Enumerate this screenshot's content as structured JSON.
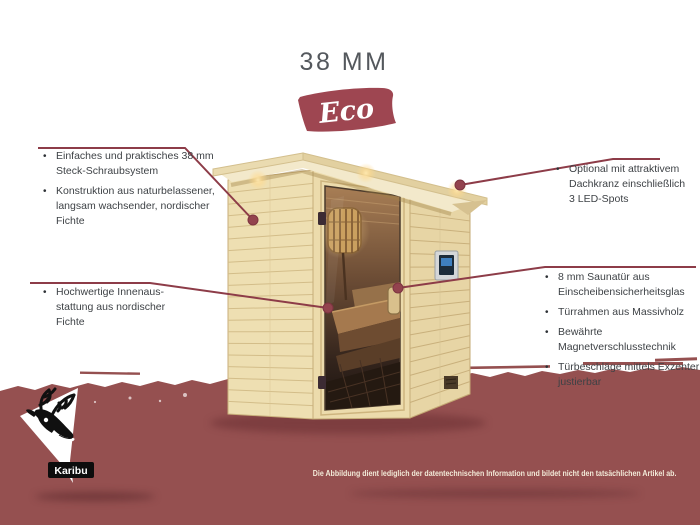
{
  "header": {
    "thickness_label": "38 MM",
    "badge_label": "Eco"
  },
  "ui": {
    "bullet_glyph": "•"
  },
  "callouts": {
    "left": [
      {
        "items": [
          {
            "text": "Einfaches und praktisches 38 mm\nSteck-Schraubsystem"
          },
          {
            "text": "Konstruktion aus naturbelassener,\nlangsam wachsender, nordischer\nFichte"
          }
        ]
      },
      {
        "items": [
          {
            "text": "Hochwertige Innenaus-\nstattung aus nordischer\nFichte"
          }
        ]
      }
    ],
    "right": [
      {
        "items": [
          {
            "text": "Optional mit attraktivem\nDachkranz einschließlich\n3 LED-Spots"
          }
        ]
      },
      {
        "items": [
          {
            "text": "8 mm Saunatür aus\nEinscheibensicherheitsglas"
          },
          {
            "text": "Türrahmen aus Massivholz"
          },
          {
            "text": "Bewährte Magnetverschlusstechnik"
          },
          {
            "text": "Türbeschläge mittels Exzenter\njustierbar"
          }
        ]
      }
    ]
  },
  "footer": {
    "disclaimer": "Die Abbildung dient lediglich der datentechnischen Information und bildet nicht den tatsächlichen Artikel ab."
  },
  "brand": {
    "logo_label": "Karibu",
    "logo_icon": "caribou-head-icon"
  },
  "colors": {
    "accent_red": "#8d3c48",
    "band_red": "#955050",
    "badge_red": "#9e4651",
    "wood_light": "#ecdcae",
    "glass_dark": "#2a1d16",
    "text_gray": "#3e4246",
    "disclaimer_cream": "#f3ebd9"
  }
}
